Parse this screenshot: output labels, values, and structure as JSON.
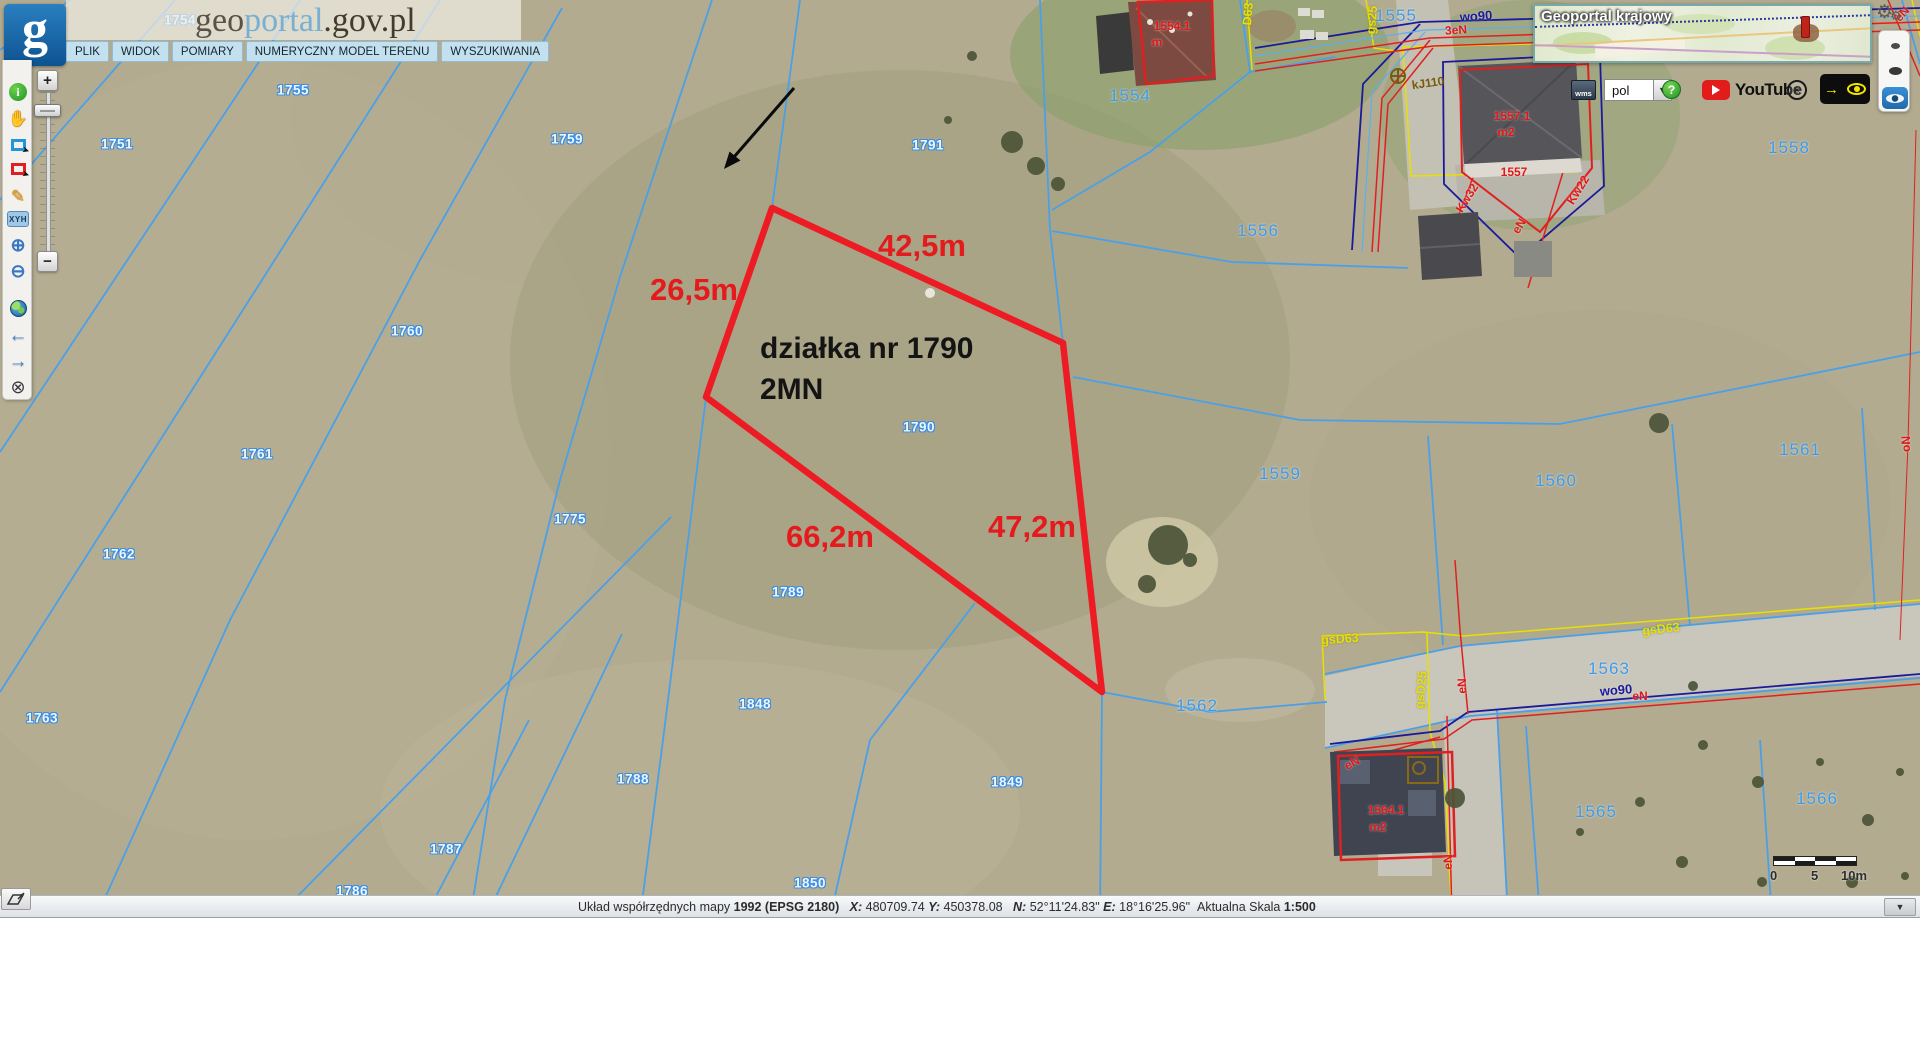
{
  "header": {
    "logo_letter": "g",
    "title": {
      "part1": "geo",
      "part2": "portal",
      "part3": ".gov.pl"
    },
    "menu": [
      "PLIK",
      "WIDOK",
      "POMIARY",
      "NUMERYCZNY MODEL TERENU",
      "WYSZUKIWANIA"
    ]
  },
  "left_toolbar": {
    "xyh_label": "XYH",
    "slider_plus": "+",
    "slider_minus": "−"
  },
  "overview_map": {
    "title": "Geoportal krajowy"
  },
  "top_right_toolbar": {
    "wms_label": "wms",
    "language_value": "pol",
    "help_label": "?",
    "youtube_label": "YouTube",
    "wheel_glyph": "✳",
    "arrow_glyph": "→"
  },
  "annotation": {
    "parcel_points": "772,208 1063,343 1102,692 706,397",
    "parcel_color": "#ed1c24",
    "note_line1": "działka nr 1790",
    "note_line2": "2MN",
    "measurements": [
      {
        "text": "42,5m",
        "x": 922,
        "y": 246
      },
      {
        "text": "26,5m",
        "x": 694,
        "y": 290
      },
      {
        "text": "66,2m",
        "x": 830,
        "y": 537
      },
      {
        "text": "47,2m",
        "x": 1032,
        "y": 527
      }
    ]
  },
  "map_labels": {
    "halo": [
      {
        "text": "1754",
        "x": 180,
        "y": 20
      },
      {
        "text": "1755",
        "x": 293,
        "y": 90
      },
      {
        "text": "1751",
        "x": 117,
        "y": 144
      },
      {
        "text": "1759",
        "x": 567,
        "y": 139
      },
      {
        "text": "1791",
        "x": 928,
        "y": 145
      },
      {
        "text": "1760",
        "x": 407,
        "y": 331
      },
      {
        "text": "1790",
        "x": 919,
        "y": 427
      },
      {
        "text": "1761",
        "x": 257,
        "y": 454
      },
      {
        "text": "1775",
        "x": 570,
        "y": 519
      },
      {
        "text": "1762",
        "x": 119,
        "y": 554
      },
      {
        "text": "1789",
        "x": 788,
        "y": 592
      },
      {
        "text": "1763",
        "x": 42,
        "y": 718
      },
      {
        "text": "1848",
        "x": 755,
        "y": 704
      },
      {
        "text": "1788",
        "x": 633,
        "y": 779
      },
      {
        "text": "1849",
        "x": 1007,
        "y": 782
      },
      {
        "text": "1787",
        "x": 446,
        "y": 849
      },
      {
        "text": "1850",
        "x": 810,
        "y": 883
      },
      {
        "text": "1786",
        "x": 352,
        "y": 891
      }
    ],
    "blue": [
      {
        "text": "1554",
        "x": 1130,
        "y": 96
      },
      {
        "text": "1555",
        "x": 1396,
        "y": 16
      },
      {
        "text": "1556",
        "x": 1258,
        "y": 231
      },
      {
        "text": "1558",
        "x": 1789,
        "y": 148
      },
      {
        "text": "1559",
        "x": 1280,
        "y": 474
      },
      {
        "text": "1560",
        "x": 1556,
        "y": 481
      },
      {
        "text": "1561",
        "x": 1800,
        "y": 450
      },
      {
        "text": "1562",
        "x": 1197,
        "y": 706
      },
      {
        "text": "1563",
        "x": 1609,
        "y": 669
      },
      {
        "text": "1565",
        "x": 1596,
        "y": 812
      },
      {
        "text": "1566",
        "x": 1817,
        "y": 799
      }
    ],
    "red": [
      {
        "text": "1554.1",
        "x": 1172,
        "y": 26
      },
      {
        "text": "m",
        "x": 1157,
        "y": 42
      },
      {
        "text": "1557.1",
        "x": 1512,
        "y": 116
      },
      {
        "text": "m2",
        "x": 1506,
        "y": 132
      },
      {
        "text": "1557",
        "x": 1514,
        "y": 172
      },
      {
        "text": "1564.1",
        "x": 1386,
        "y": 810
      },
      {
        "text": "m2",
        "x": 1378,
        "y": 827
      },
      {
        "text": "3eN",
        "x": 1456,
        "y": 30,
        "rot": -4
      },
      {
        "text": "eN",
        "x": 1462,
        "y": 686,
        "rot": -90
      },
      {
        "text": "eN",
        "x": 1352,
        "y": 763,
        "rot": -28
      },
      {
        "text": "eN",
        "x": 1640,
        "y": 696
      },
      {
        "text": "eN",
        "x": 1448,
        "y": 862,
        "rot": -90
      },
      {
        "text": "Kw32",
        "x": 1467,
        "y": 198,
        "rot": -58
      },
      {
        "text": "Kw22",
        "x": 1578,
        "y": 190,
        "rot": -58
      },
      {
        "text": "eN",
        "x": 1519,
        "y": 226,
        "rot": -58
      },
      {
        "text": "oN",
        "x": 1906,
        "y": 444,
        "rot": -90
      },
      {
        "text": "eN",
        "x": 1902,
        "y": 14,
        "rot": -48
      }
    ],
    "navy": [
      {
        "text": "wo90",
        "x": 1476,
        "y": 16,
        "rot": -4
      },
      {
        "text": "wo90",
        "x": 1616,
        "y": 690,
        "rot": -5
      }
    ],
    "yellow": [
      {
        "text": "gsD63",
        "x": 1340,
        "y": 639,
        "rot": -4
      },
      {
        "text": "gsD63",
        "x": 1661,
        "y": 629,
        "rot": -6
      },
      {
        "text": "gsD25",
        "x": 1421,
        "y": 690,
        "rot": -85
      },
      {
        "text": "gs25",
        "x": 1372,
        "y": 20,
        "rot": -85
      },
      {
        "text": "D63",
        "x": 1248,
        "y": 14,
        "rot": -85
      }
    ],
    "brown": [
      {
        "text": "kJ110",
        "x": 1428,
        "y": 83,
        "rot": -8
      }
    ]
  },
  "scalebar": {
    "labels": [
      "0",
      "5",
      "10m"
    ]
  },
  "statusbar": {
    "segments": [
      {
        "text": "Układ współrzędnych mapy "
      },
      {
        "text": "1992 (EPSG 2180)",
        "b": true
      },
      {
        "text": "   "
      },
      {
        "text": "X:",
        "b": true,
        "i": true
      },
      {
        "text": " 480709.74 "
      },
      {
        "text": "Y:",
        "b": true,
        "i": true
      },
      {
        "text": " 450378.08   "
      },
      {
        "text": "N:",
        "b": true,
        "i": true
      },
      {
        "text": " 52°11'24.83\" "
      },
      {
        "text": "E:",
        "b": true,
        "i": true
      },
      {
        "text": " 18°16'25.96\"  "
      },
      {
        "text": "Aktualna Skala "
      },
      {
        "text": "1:500",
        "b": true
      }
    ]
  }
}
